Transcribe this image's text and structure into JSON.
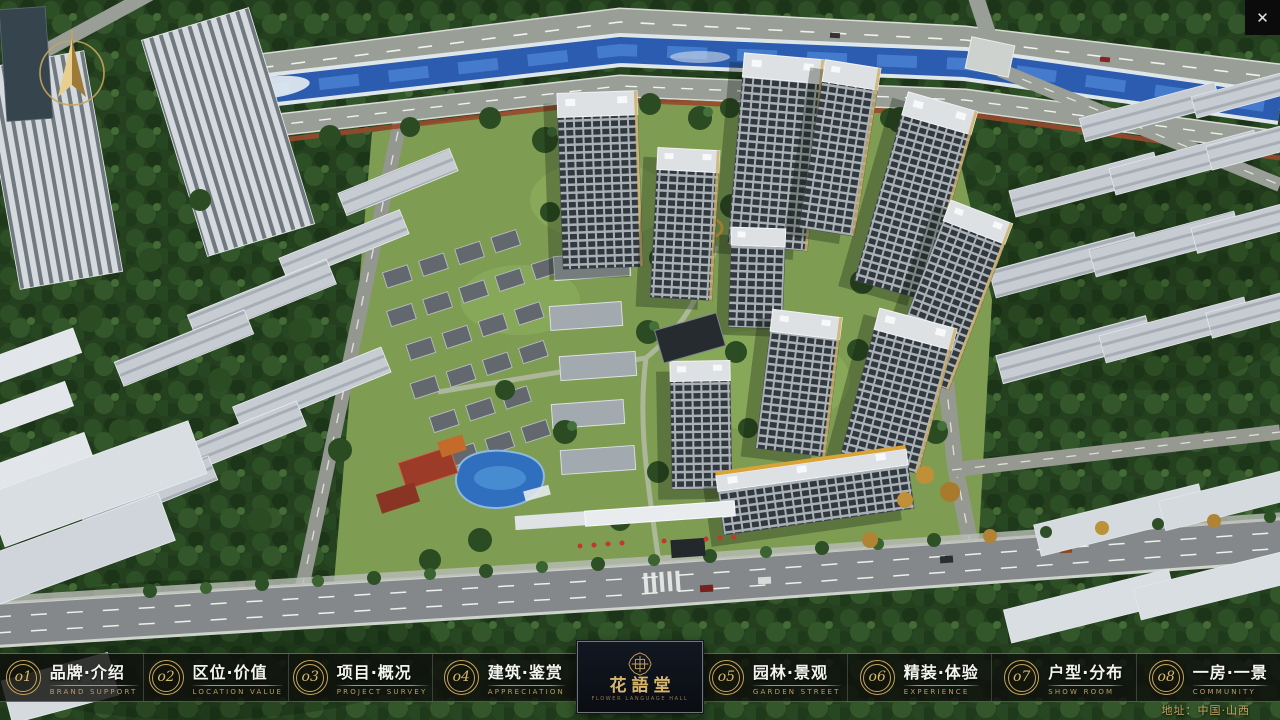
{
  "window": {
    "close_label": "✕"
  },
  "map": {
    "address": "地址：中国·山西"
  },
  "nav": {
    "items": [
      {
        "num": "o1",
        "label": "品牌·介绍",
        "sub": "BRAND SUPPORT"
      },
      {
        "num": "o2",
        "label": "区位·价值",
        "sub": "LOCATION VALUE"
      },
      {
        "num": "o3",
        "label": "项目·概况",
        "sub": "PROJECT SURVEY"
      },
      {
        "num": "o4",
        "label": "建筑·鉴赏",
        "sub": "APPRECIATION"
      },
      {
        "num": "o5",
        "label": "园林·景观",
        "sub": "GARDEN STREET"
      },
      {
        "num": "o6",
        "label": "精装·体验",
        "sub": "EXPERIENCE"
      },
      {
        "num": "o7",
        "label": "户型·分布",
        "sub": "SHOW ROOM"
      },
      {
        "num": "o8",
        "label": "一房·一景",
        "sub": "COMMUNITY"
      }
    ]
  },
  "logo": {
    "title": "花語堂",
    "tagline": "FLOWER LANGUAGE HALL"
  },
  "colors": {
    "accent_gold": "#C9A963",
    "bar_bg": "#0E100D",
    "river_blue": "#2C5CB0",
    "grass_green": "#7E9D53"
  }
}
